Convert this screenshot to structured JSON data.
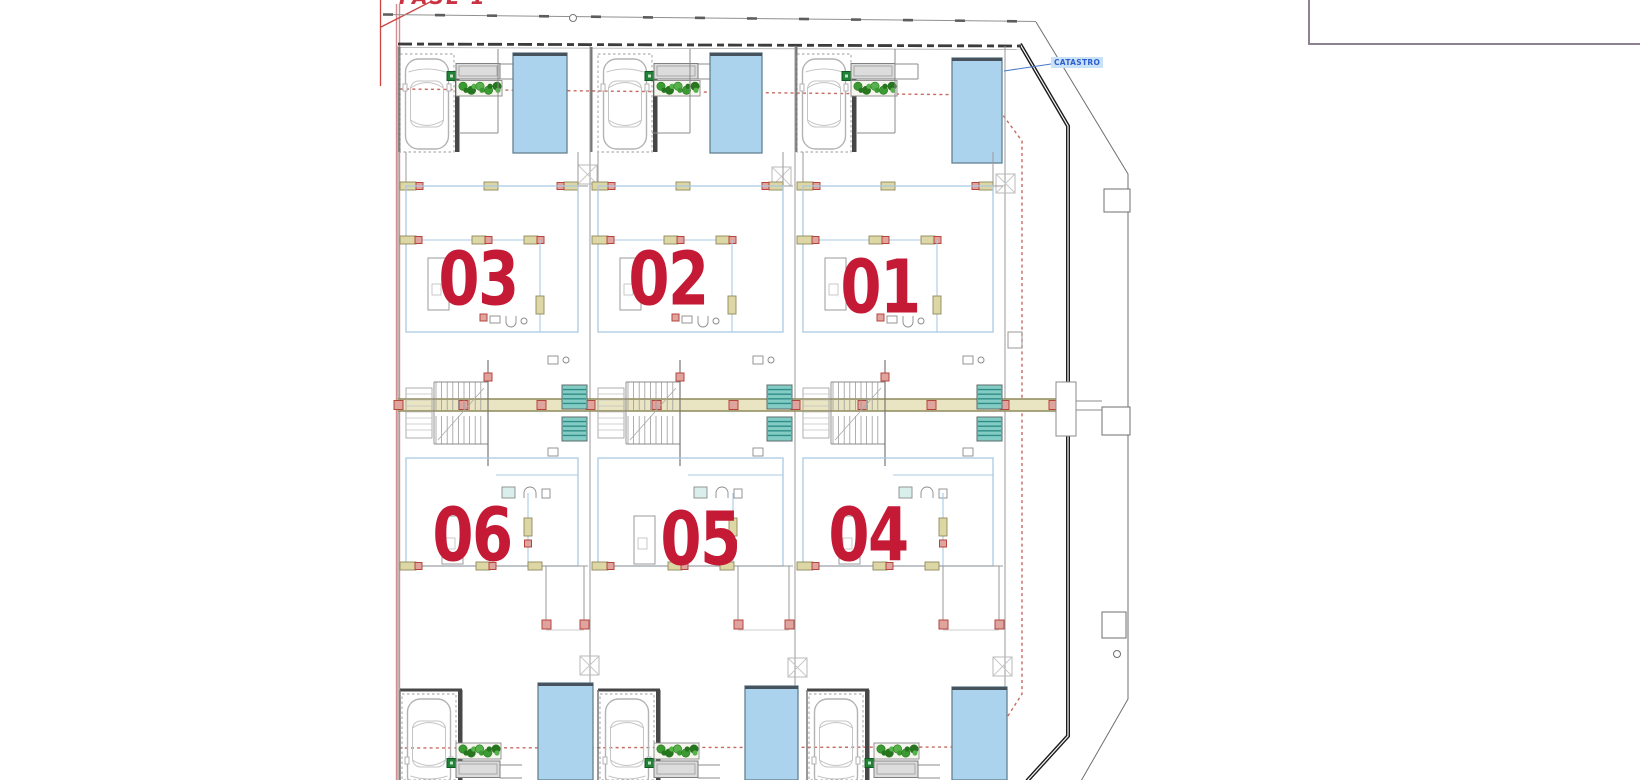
{
  "labels": {
    "fase": "FASE 1",
    "catastro": "CATASTRO"
  },
  "units": [
    {
      "number": "03"
    },
    {
      "number": "02"
    },
    {
      "number": "01"
    },
    {
      "number": "06"
    },
    {
      "number": "05"
    },
    {
      "number": "04"
    }
  ],
  "colors": {
    "unit_number": "#c41a35",
    "fase_red": "#c93343",
    "catastro_text_blue": "#2f5fd1",
    "catastro_highlight": "#c9e2f7",
    "title_block_border": "#8d8292",
    "pool_fill": "#abd3ee",
    "pool_edge_dark": "#46525c",
    "pool_border": "#64808f",
    "boundary_pink": "#d38f8f",
    "setback_red_dotted": "#c96a62",
    "wall_blue": "#a9c9e2",
    "wall_tan": "#ddd7a6",
    "wall_tan_border": "#8f895c",
    "spine_fill": "#e9e5c2",
    "junction_red_fill": "#dfa49e",
    "junction_red_border": "#b6453c",
    "tile_teal": "#83ccc4",
    "tile_teal_dark": "#2f8d87",
    "plant_green_dark": "#27761f",
    "plant_green": "#3c9a33",
    "plant_green_light": "#57b24b",
    "gate_green": "#1f8236",
    "gate_green_border": "#0e5a20",
    "step_gray_fill": "#dcdcdc",
    "garage_wall_dark": "#474747",
    "boundary_dark": "#1c1c1c",
    "line_gray": "#8b8b8b",
    "car_outline_gray": "#b3b3b3"
  }
}
